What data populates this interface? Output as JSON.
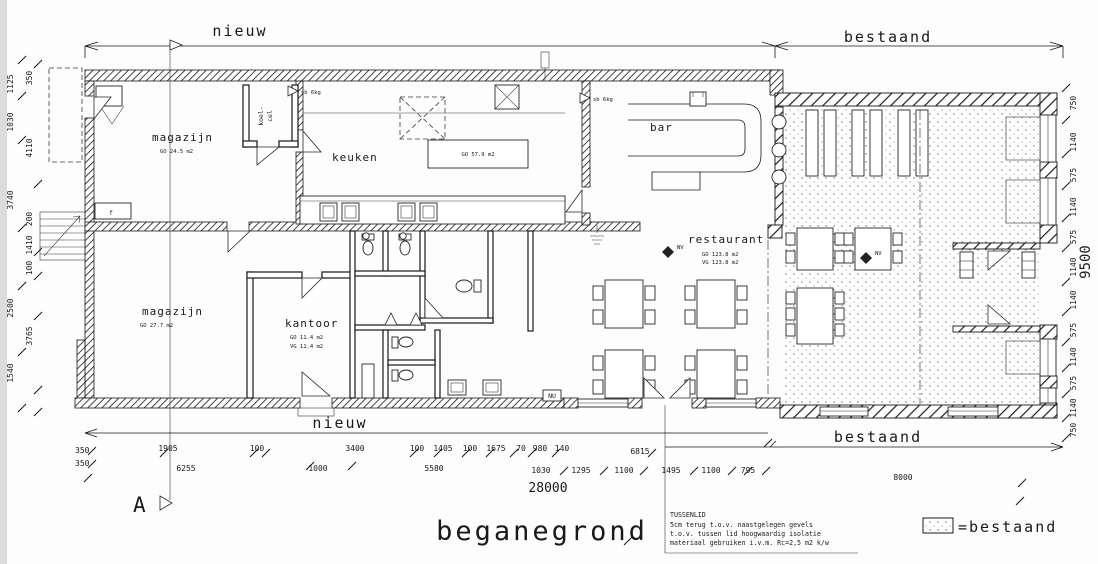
{
  "drawing": {
    "scale_labels": {
      "top_nieuw": "nieuw",
      "top_bestaand": "bestaand",
      "bottom_nieuw": "nieuw",
      "bottom_bestaand": "bestaand"
    },
    "caption": "beganegrond",
    "section_marker": "A",
    "legend": {
      "label": "=bestaand"
    },
    "rooms": {
      "magazijn_top": {
        "name": "magazijn",
        "area": "GO 24.5 m2"
      },
      "koelcel": {
        "line1": "koel-",
        "line2": "cel"
      },
      "keuken": {
        "name": "keuken",
        "worktop_area": "GO 57.9 m2"
      },
      "bar": {
        "name": "bar"
      },
      "restaurant": {
        "name": "restaurant",
        "area_go": "GO 123.8 m2",
        "area_vg": "VG 123.8 m2"
      },
      "magazijn_bottom": {
        "name": "magazijn",
        "area": "GO 27.7 m2"
      },
      "kantoor": {
        "name": "kantoor",
        "area_go": "GO 11.4 m2",
        "area_vg": "VG 11.4 m2"
      }
    },
    "symbols": {
      "fire_extinguisher_1": "sb 6kg",
      "fire_extinguisher_2": "sb 6kg",
      "exit_sign": "NU",
      "vent_1": "NV",
      "vent_2": "NV",
      "fixture_f": "f"
    },
    "note": {
      "title": "TUSSENLID",
      "line2": "5cm terug t.o.v. naastgelegen gevels",
      "line3": "t.o.v. tussen lid hoogwaardig isolatie",
      "line4": "materiaal gebruiken i.v.m. Rc=2,5 m2 k/w"
    },
    "dimensions": {
      "left": [
        "1125",
        "350",
        "1030",
        "4110",
        "3740",
        "200",
        "1410",
        "100",
        "2500",
        "3765",
        "1540"
      ],
      "right_chain": [
        "750",
        "1140",
        "575",
        "1140",
        "575",
        "1140",
        "1140",
        "575",
        "1140",
        "575",
        "1140",
        "750"
      ],
      "right_total": "9500",
      "bottom_350": [
        "350",
        "350"
      ],
      "bottom_row1": [
        "1905",
        "100",
        "3400",
        "100",
        "1405",
        "100",
        "1675",
        "70",
        "980",
        "140"
      ],
      "bottom_row_lower": [
        "6255",
        "1000",
        "5580",
        "1030",
        "1295",
        "1100",
        "1495",
        "1100",
        "795"
      ],
      "bottom_totals": {
        "t6815": "6815",
        "t8000": "8000",
        "t28000": "28000"
      }
    },
    "colors": {
      "ink": "#1a1a1a",
      "paper": "#ffffff"
    }
  }
}
